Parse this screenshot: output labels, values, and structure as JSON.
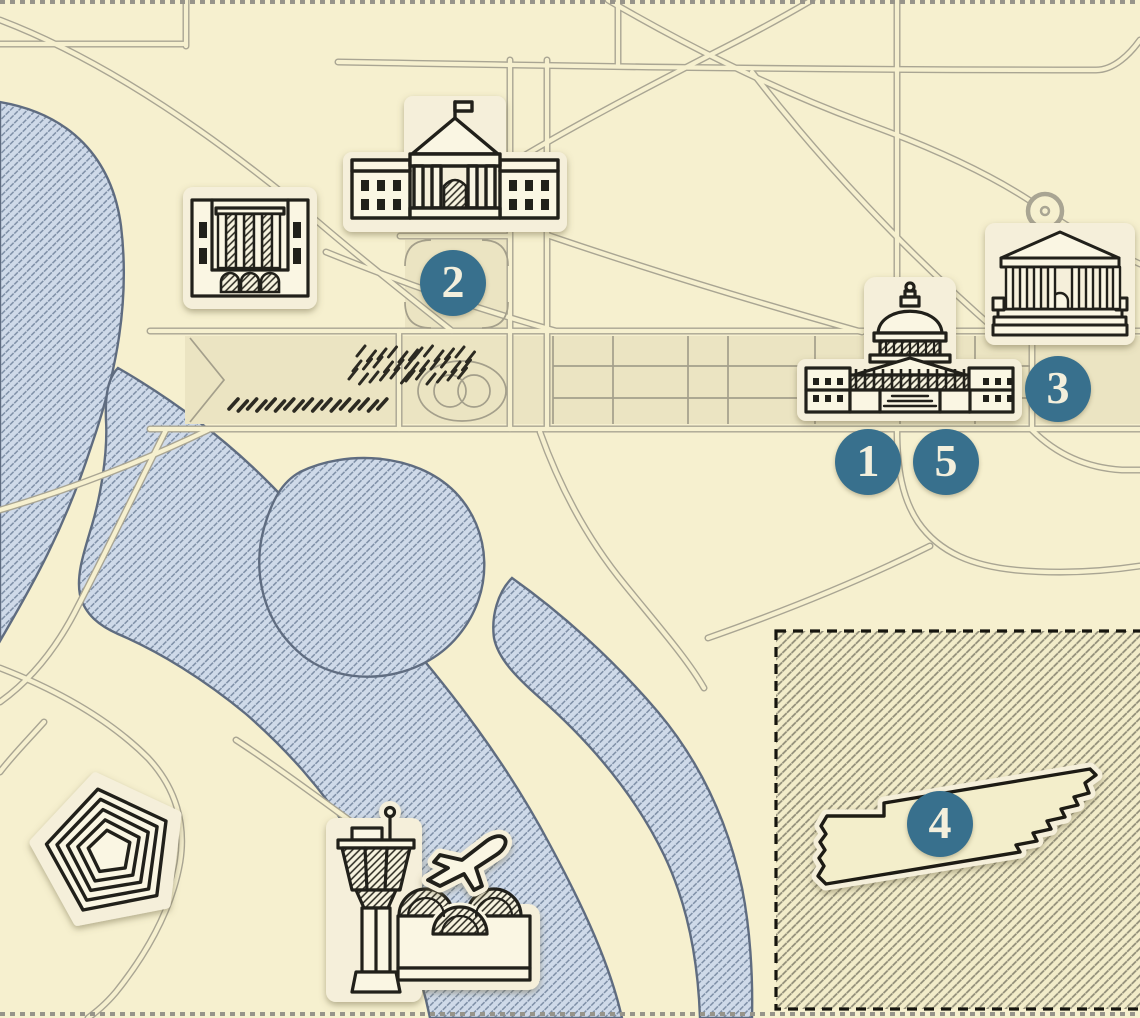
{
  "map": {
    "name": "washington-dc-illustrated-quiz-map",
    "markers": [
      {
        "label": "1"
      },
      {
        "label": "2"
      },
      {
        "label": "3"
      },
      {
        "label": "4"
      },
      {
        "label": "5"
      }
    ],
    "icons": {
      "white_house": "white-house-icon",
      "federal_building": "federal-building-icon",
      "us_capitol": "capitol-icon",
      "supreme_court": "supreme-court-icon",
      "pentagon": "pentagon-icon",
      "airport": "airport-control-tower-icon",
      "airplane": "airplane-icon",
      "tennessee": "tennessee-state-shape-icon"
    },
    "colors": {
      "background": "#f6f0cf",
      "mall_panel": "#ebe4c2",
      "road_line": "#a9a593",
      "water_fill": "#cfdae9",
      "water_hatch": "#7d8ea5",
      "water_shore": "#5f6c80",
      "ink": "#21201a",
      "sticker_fill": "#faf6e3",
      "sticker_halo": "#f5efda",
      "marker_fill": "#38708d",
      "marker_text": "#f3efdc",
      "inset_background": "#f2ecc9",
      "inset_hatch": "#8e8b76",
      "border_dots": "#97948a"
    }
  }
}
